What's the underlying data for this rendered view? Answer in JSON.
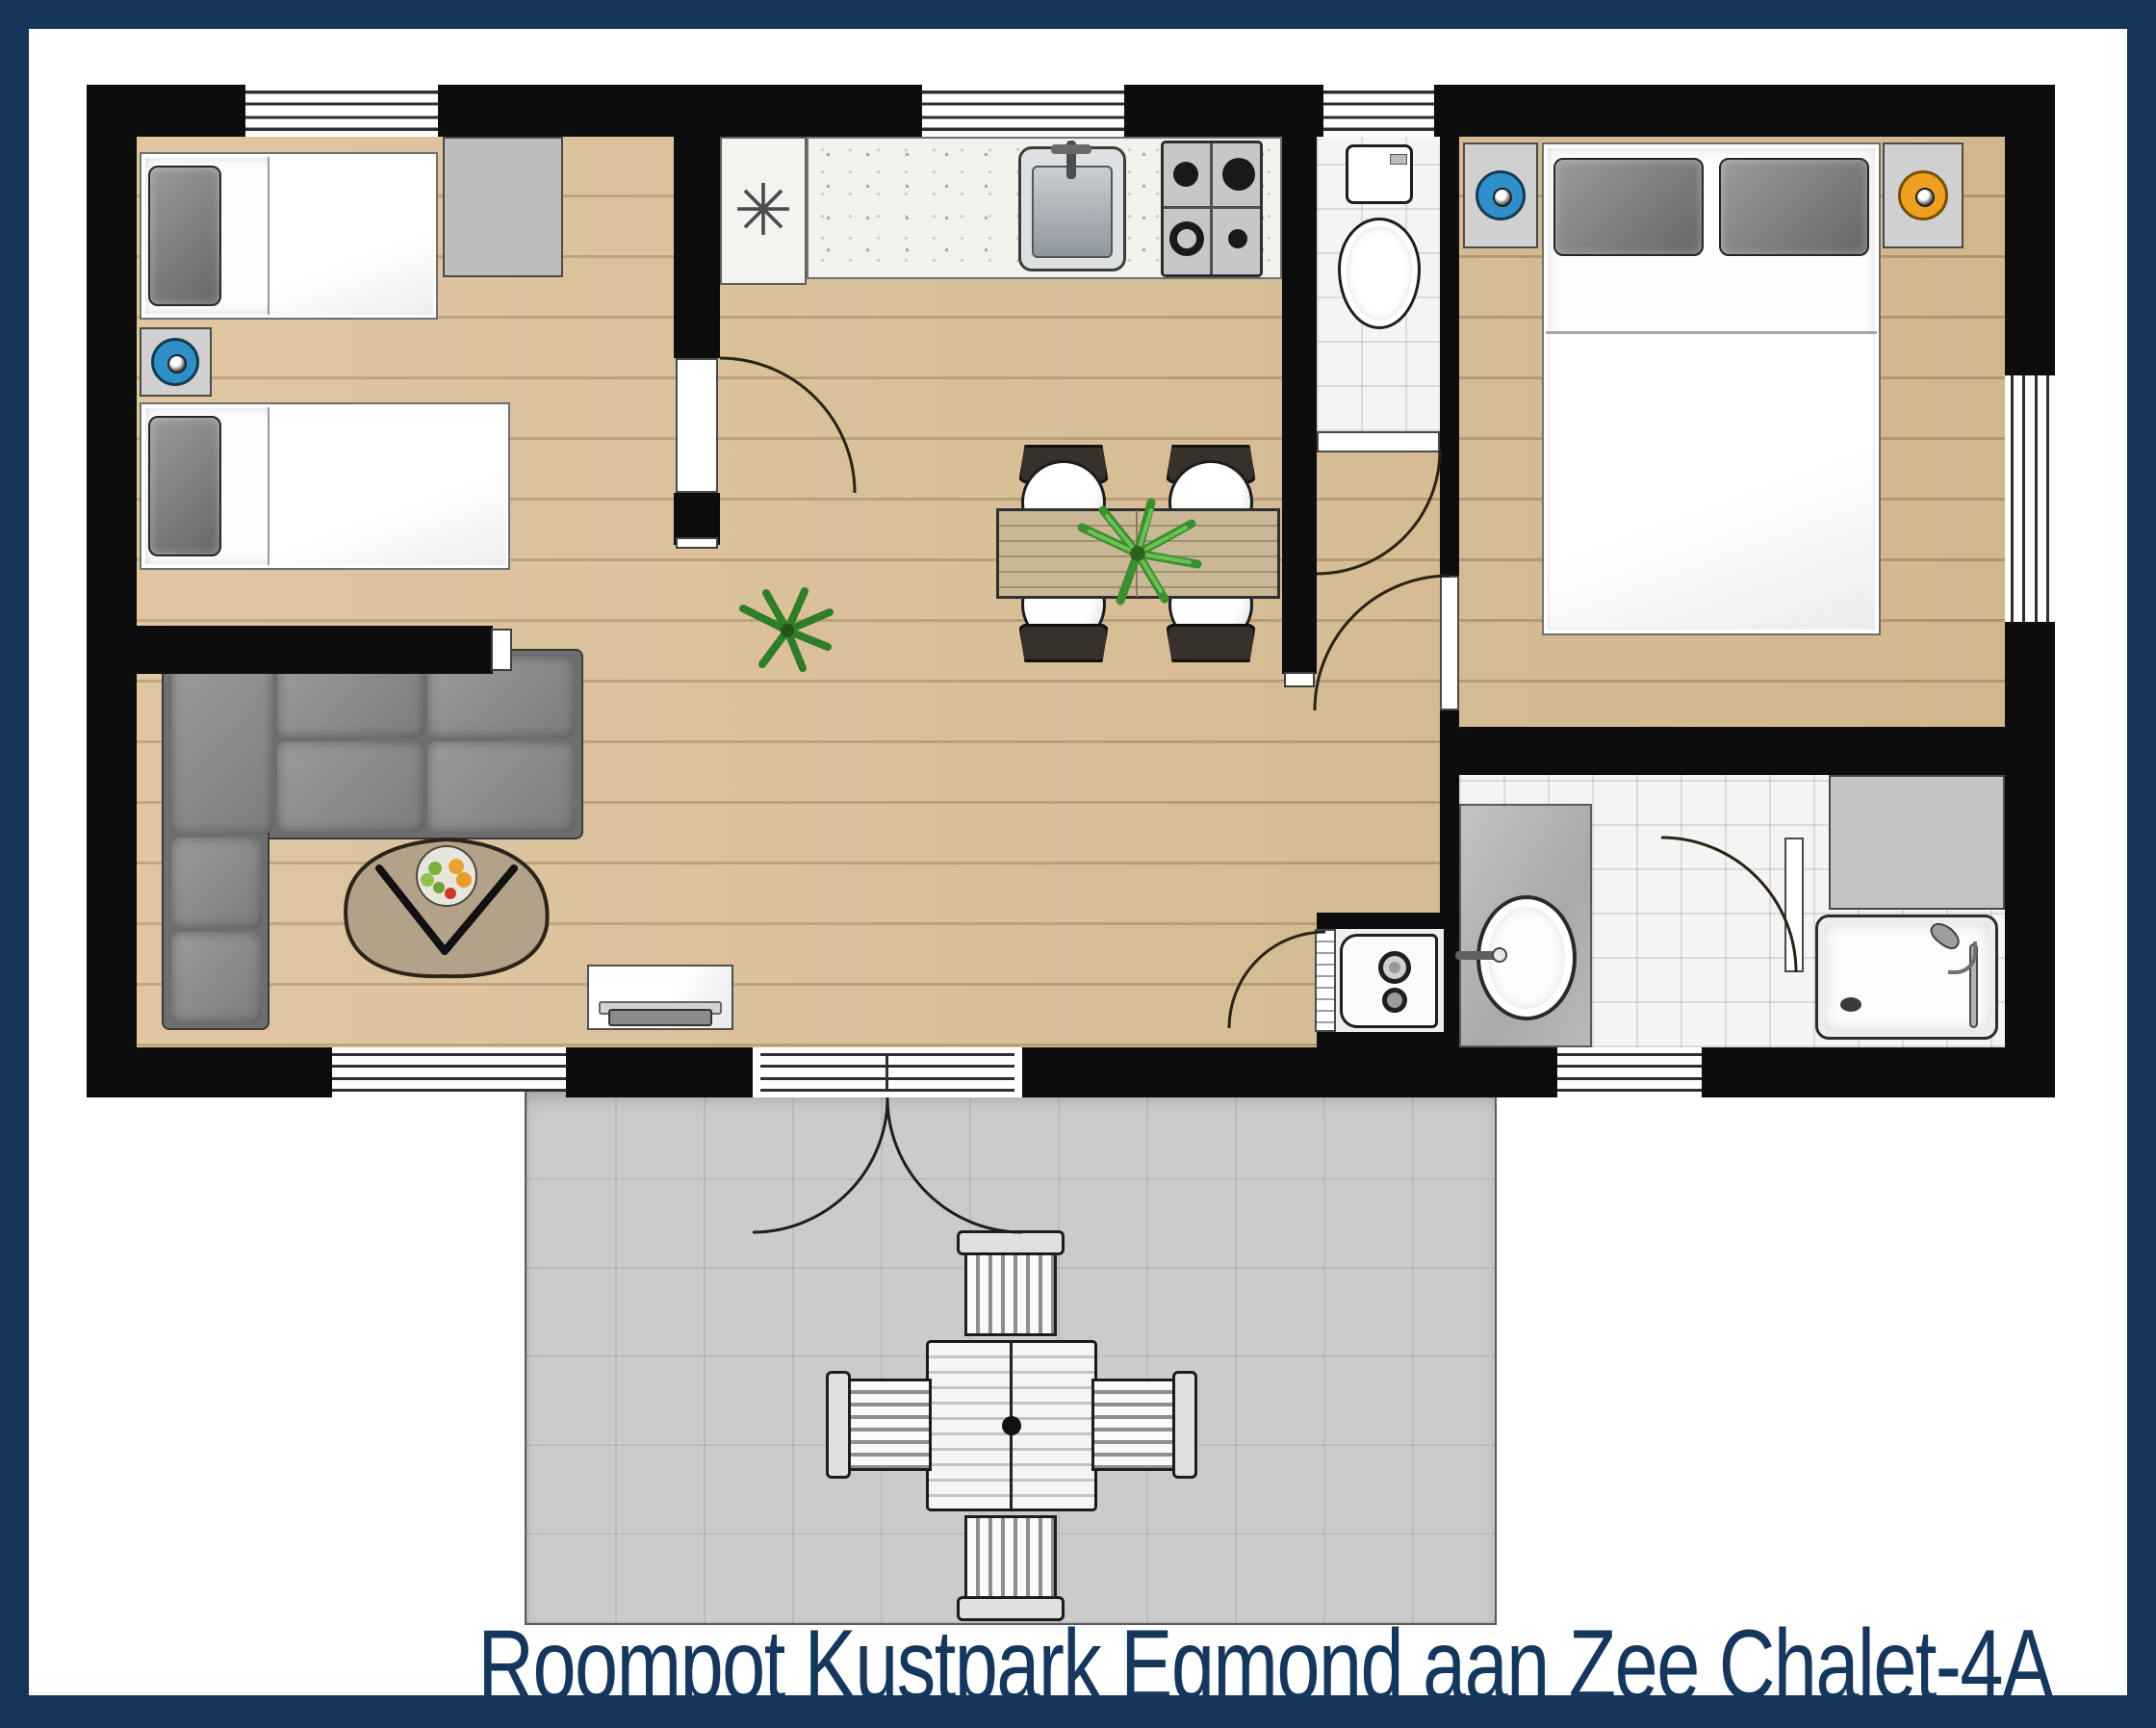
{
  "caption": {
    "text": "Roompot Kustpark Egmond aan Zee Chalet-4A"
  },
  "symbols": {
    "freezer": "✳"
  },
  "palette": {
    "border_navy": "#143459",
    "caption_navy": "#15365d",
    "wall_black": "#0d0d0d",
    "wood_floor": "#dcc096",
    "tile_white": "#f4f4f4",
    "terrace_gray": "#cbcbcb",
    "lamp_blue": "#2f8fc8",
    "lamp_orange": "#eea11f",
    "plant_green": "#3c8f2e",
    "sofa_gray": "#7c7c7c"
  }
}
